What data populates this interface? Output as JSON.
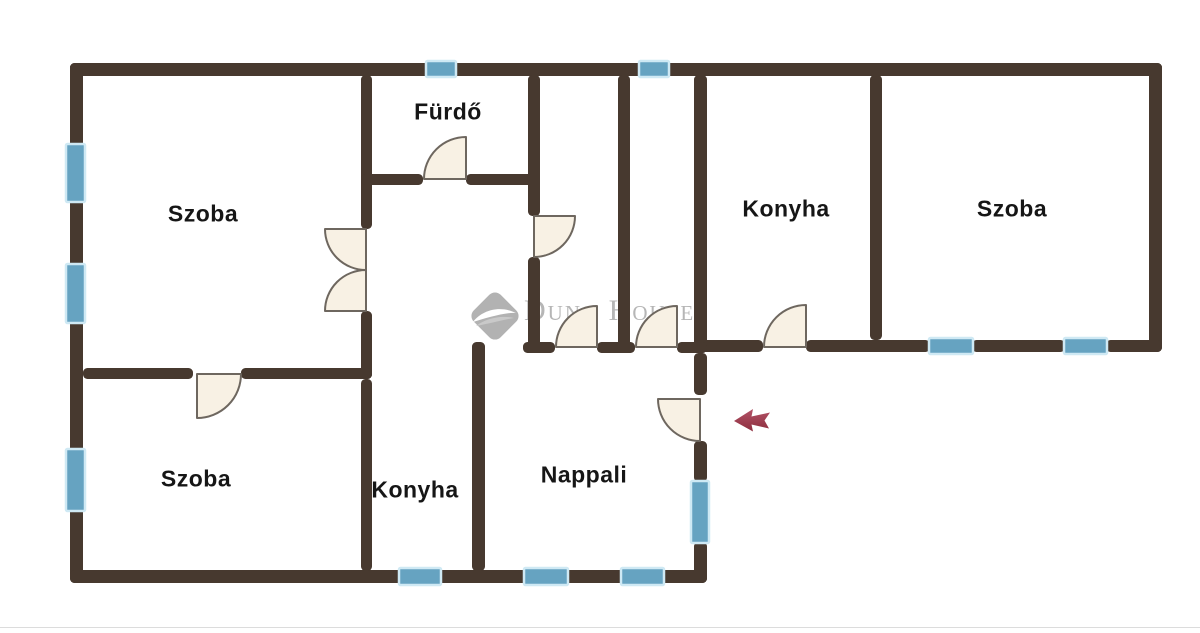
{
  "title": "Apartment floor plan",
  "colors": {
    "wall": "#47392f",
    "door_fill": "#f8f1e4",
    "door_stroke": "#6e675f",
    "window_fill": "#66a3c1",
    "window_border": "#cfe9f4",
    "label": "#161616",
    "watermark": "#b6b6b6",
    "arrow_top": "#b25266",
    "arrow_bottom": "#8d2e3e",
    "baseline_rule": "#dcdcdc"
  },
  "rooms": [
    {
      "id": "szoba-top-left",
      "label": "Szoba",
      "cx": 203,
      "cy": 214
    },
    {
      "id": "furdo",
      "label": "Fürdő",
      "cx": 448,
      "cy": 112
    },
    {
      "id": "konyha-top",
      "label": "Konyha",
      "cx": 786,
      "cy": 209
    },
    {
      "id": "szoba-right",
      "label": "Szoba",
      "cx": 1012,
      "cy": 209
    },
    {
      "id": "szoba-bottom-left",
      "label": "Szoba",
      "cx": 196,
      "cy": 479
    },
    {
      "id": "konyha-bottom",
      "label": "Konyha",
      "cx": 415,
      "cy": 490
    },
    {
      "id": "nappali",
      "label": "Nappali",
      "cx": 584,
      "cy": 475
    }
  ],
  "walls": [
    {
      "x": 70,
      "y": 63,
      "w": 1092,
      "h": 13
    },
    {
      "x": 70,
      "y": 63,
      "w": 13,
      "h": 520
    },
    {
      "x": 70,
      "y": 570,
      "w": 637,
      "h": 13
    },
    {
      "x": 1149,
      "y": 63,
      "w": 13,
      "h": 289
    },
    {
      "x": 697,
      "y": 340,
      "w": 66,
      "h": 12
    },
    {
      "x": 806,
      "y": 340,
      "w": 124,
      "h": 12
    },
    {
      "x": 972,
      "y": 340,
      "w": 93,
      "h": 12
    },
    {
      "x": 1106,
      "y": 340,
      "w": 56,
      "h": 12
    },
    {
      "x": 361,
      "y": 75,
      "w": 11,
      "h": 154
    },
    {
      "x": 361,
      "y": 311,
      "w": 11,
      "h": 68
    },
    {
      "x": 83,
      "y": 368,
      "w": 110,
      "h": 11
    },
    {
      "x": 241,
      "y": 368,
      "w": 131,
      "h": 11
    },
    {
      "x": 361,
      "y": 379,
      "w": 11,
      "h": 192
    },
    {
      "x": 361,
      "y": 174,
      "w": 62,
      "h": 11
    },
    {
      "x": 466,
      "y": 174,
      "w": 74,
      "h": 11
    },
    {
      "x": 528,
      "y": 75,
      "w": 12,
      "h": 141
    },
    {
      "x": 528,
      "y": 257,
      "w": 12,
      "h": 96
    },
    {
      "x": 618,
      "y": 75,
      "w": 12,
      "h": 278
    },
    {
      "x": 694,
      "y": 75,
      "w": 13,
      "h": 278
    },
    {
      "x": 694,
      "y": 353,
      "w": 13,
      "h": 42
    },
    {
      "x": 694,
      "y": 441,
      "w": 13,
      "h": 41
    },
    {
      "x": 694,
      "y": 542,
      "w": 13,
      "h": 41
    },
    {
      "x": 523,
      "y": 342,
      "w": 32,
      "h": 11
    },
    {
      "x": 597,
      "y": 342,
      "w": 38,
      "h": 11
    },
    {
      "x": 677,
      "y": 342,
      "w": 30,
      "h": 11
    },
    {
      "x": 870,
      "y": 75,
      "w": 12,
      "h": 265
    },
    {
      "x": 472,
      "y": 342,
      "w": 13,
      "h": 229
    }
  ],
  "windows": [
    {
      "x": 426,
      "y": 61,
      "w": 30,
      "h": 16
    },
    {
      "x": 639,
      "y": 61,
      "w": 30,
      "h": 16
    },
    {
      "x": 66,
      "y": 144,
      "w": 19,
      "h": 58
    },
    {
      "x": 66,
      "y": 264,
      "w": 19,
      "h": 59
    },
    {
      "x": 66,
      "y": 449,
      "w": 19,
      "h": 62
    },
    {
      "x": 399,
      "y": 568,
      "w": 42,
      "h": 17
    },
    {
      "x": 524,
      "y": 568,
      "w": 44,
      "h": 17
    },
    {
      "x": 621,
      "y": 568,
      "w": 43,
      "h": 17
    },
    {
      "x": 929,
      "y": 338,
      "w": 44,
      "h": 16
    },
    {
      "x": 1064,
      "y": 338,
      "w": 43,
      "h": 16
    },
    {
      "x": 691,
      "y": 481,
      "w": 18,
      "h": 62
    }
  ],
  "doors": [
    {
      "id": "double-door-top-leaf",
      "cx": 366,
      "cy": 229,
      "r": 41,
      "a0": 180,
      "a1": 90
    },
    {
      "id": "double-door-bottom-leaf",
      "cx": 366,
      "cy": 311,
      "r": 41,
      "a0": 180,
      "a1": 270
    },
    {
      "id": "szoba-bl-door",
      "cx": 197,
      "cy": 374,
      "r": 44,
      "a0": 90,
      "a1": 0
    },
    {
      "id": "furdo-door",
      "cx": 466,
      "cy": 179,
      "r": 42,
      "a0": 270,
      "a1": 180
    },
    {
      "id": "hall-side-door",
      "cx": 534,
      "cy": 216,
      "r": 41,
      "a0": 0,
      "a1": 90
    },
    {
      "id": "hall-a-door",
      "cx": 597,
      "cy": 347,
      "r": 41,
      "a0": 270,
      "a1": 180
    },
    {
      "id": "hall-b-door",
      "cx": 677,
      "cy": 347,
      "r": 41,
      "a0": 270,
      "a1": 180
    },
    {
      "id": "konyha-top-door",
      "cx": 806,
      "cy": 347,
      "r": 42,
      "a0": 270,
      "a1": 180
    },
    {
      "id": "entrance-door",
      "cx": 700,
      "cy": 399,
      "r": 42,
      "a0": 180,
      "a1": 90
    }
  ],
  "entrance_arrow": {
    "direction": "left",
    "points": "734,421 753,409 751.5,416.5 770,412.5 764.5,420.5 769,428.5 751.5,424.5 753,431.5"
  },
  "watermark": {
    "brand": "Duna House",
    "reg": "®"
  }
}
